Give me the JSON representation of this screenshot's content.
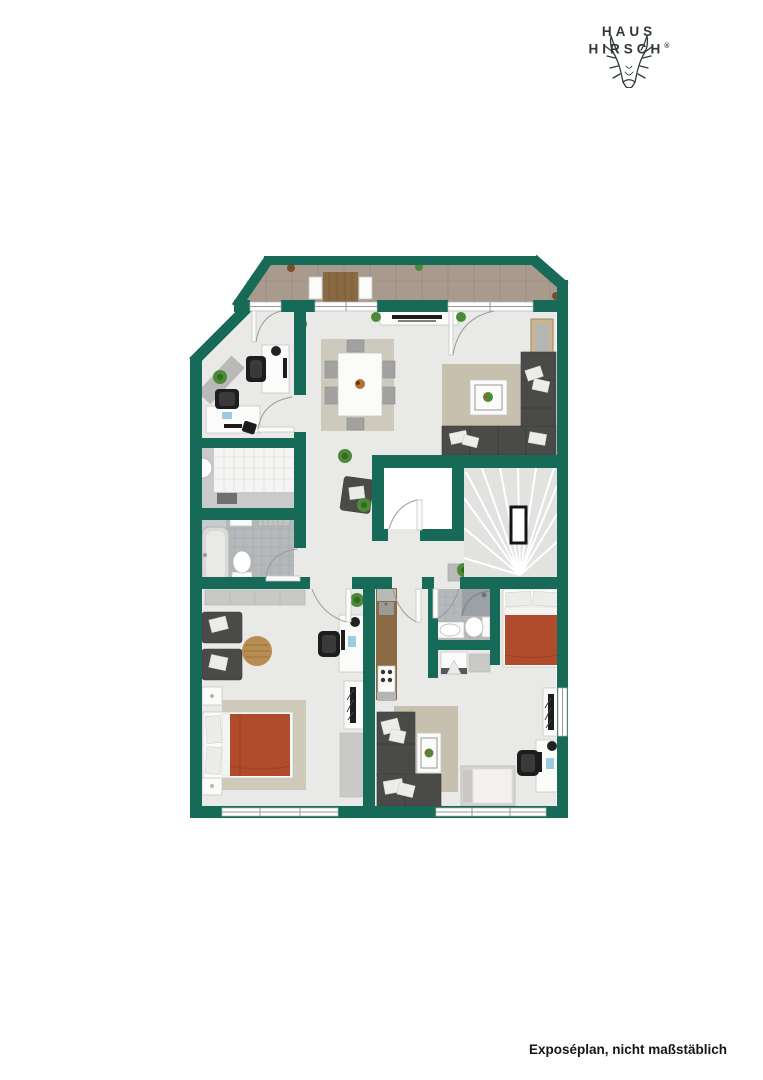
{
  "logo": {
    "name_line1": "HAUS",
    "name_line2": "HIRSCH",
    "registered": "®"
  },
  "footer": {
    "disclaimer": "Exposéplan, nicht maßstäblich"
  },
  "floorplan": {
    "colors": {
      "pagebg": "#ffffff",
      "wall": "#166a57",
      "floor": "#e9e9e7",
      "balcony": "#a89a8c",
      "rug": "#c7c0ae",
      "sofa": "#4a4a48",
      "terracotta": "#b04b2b",
      "wood": "#8a6a44",
      "tilegray": "#b4b8bb",
      "tilelight": "#c8cacb",
      "kitchentile": "#f4f4f2",
      "stairs": "#e2e2e0",
      "plant": "#4c8a39",
      "text": "#2e3938"
    }
  }
}
